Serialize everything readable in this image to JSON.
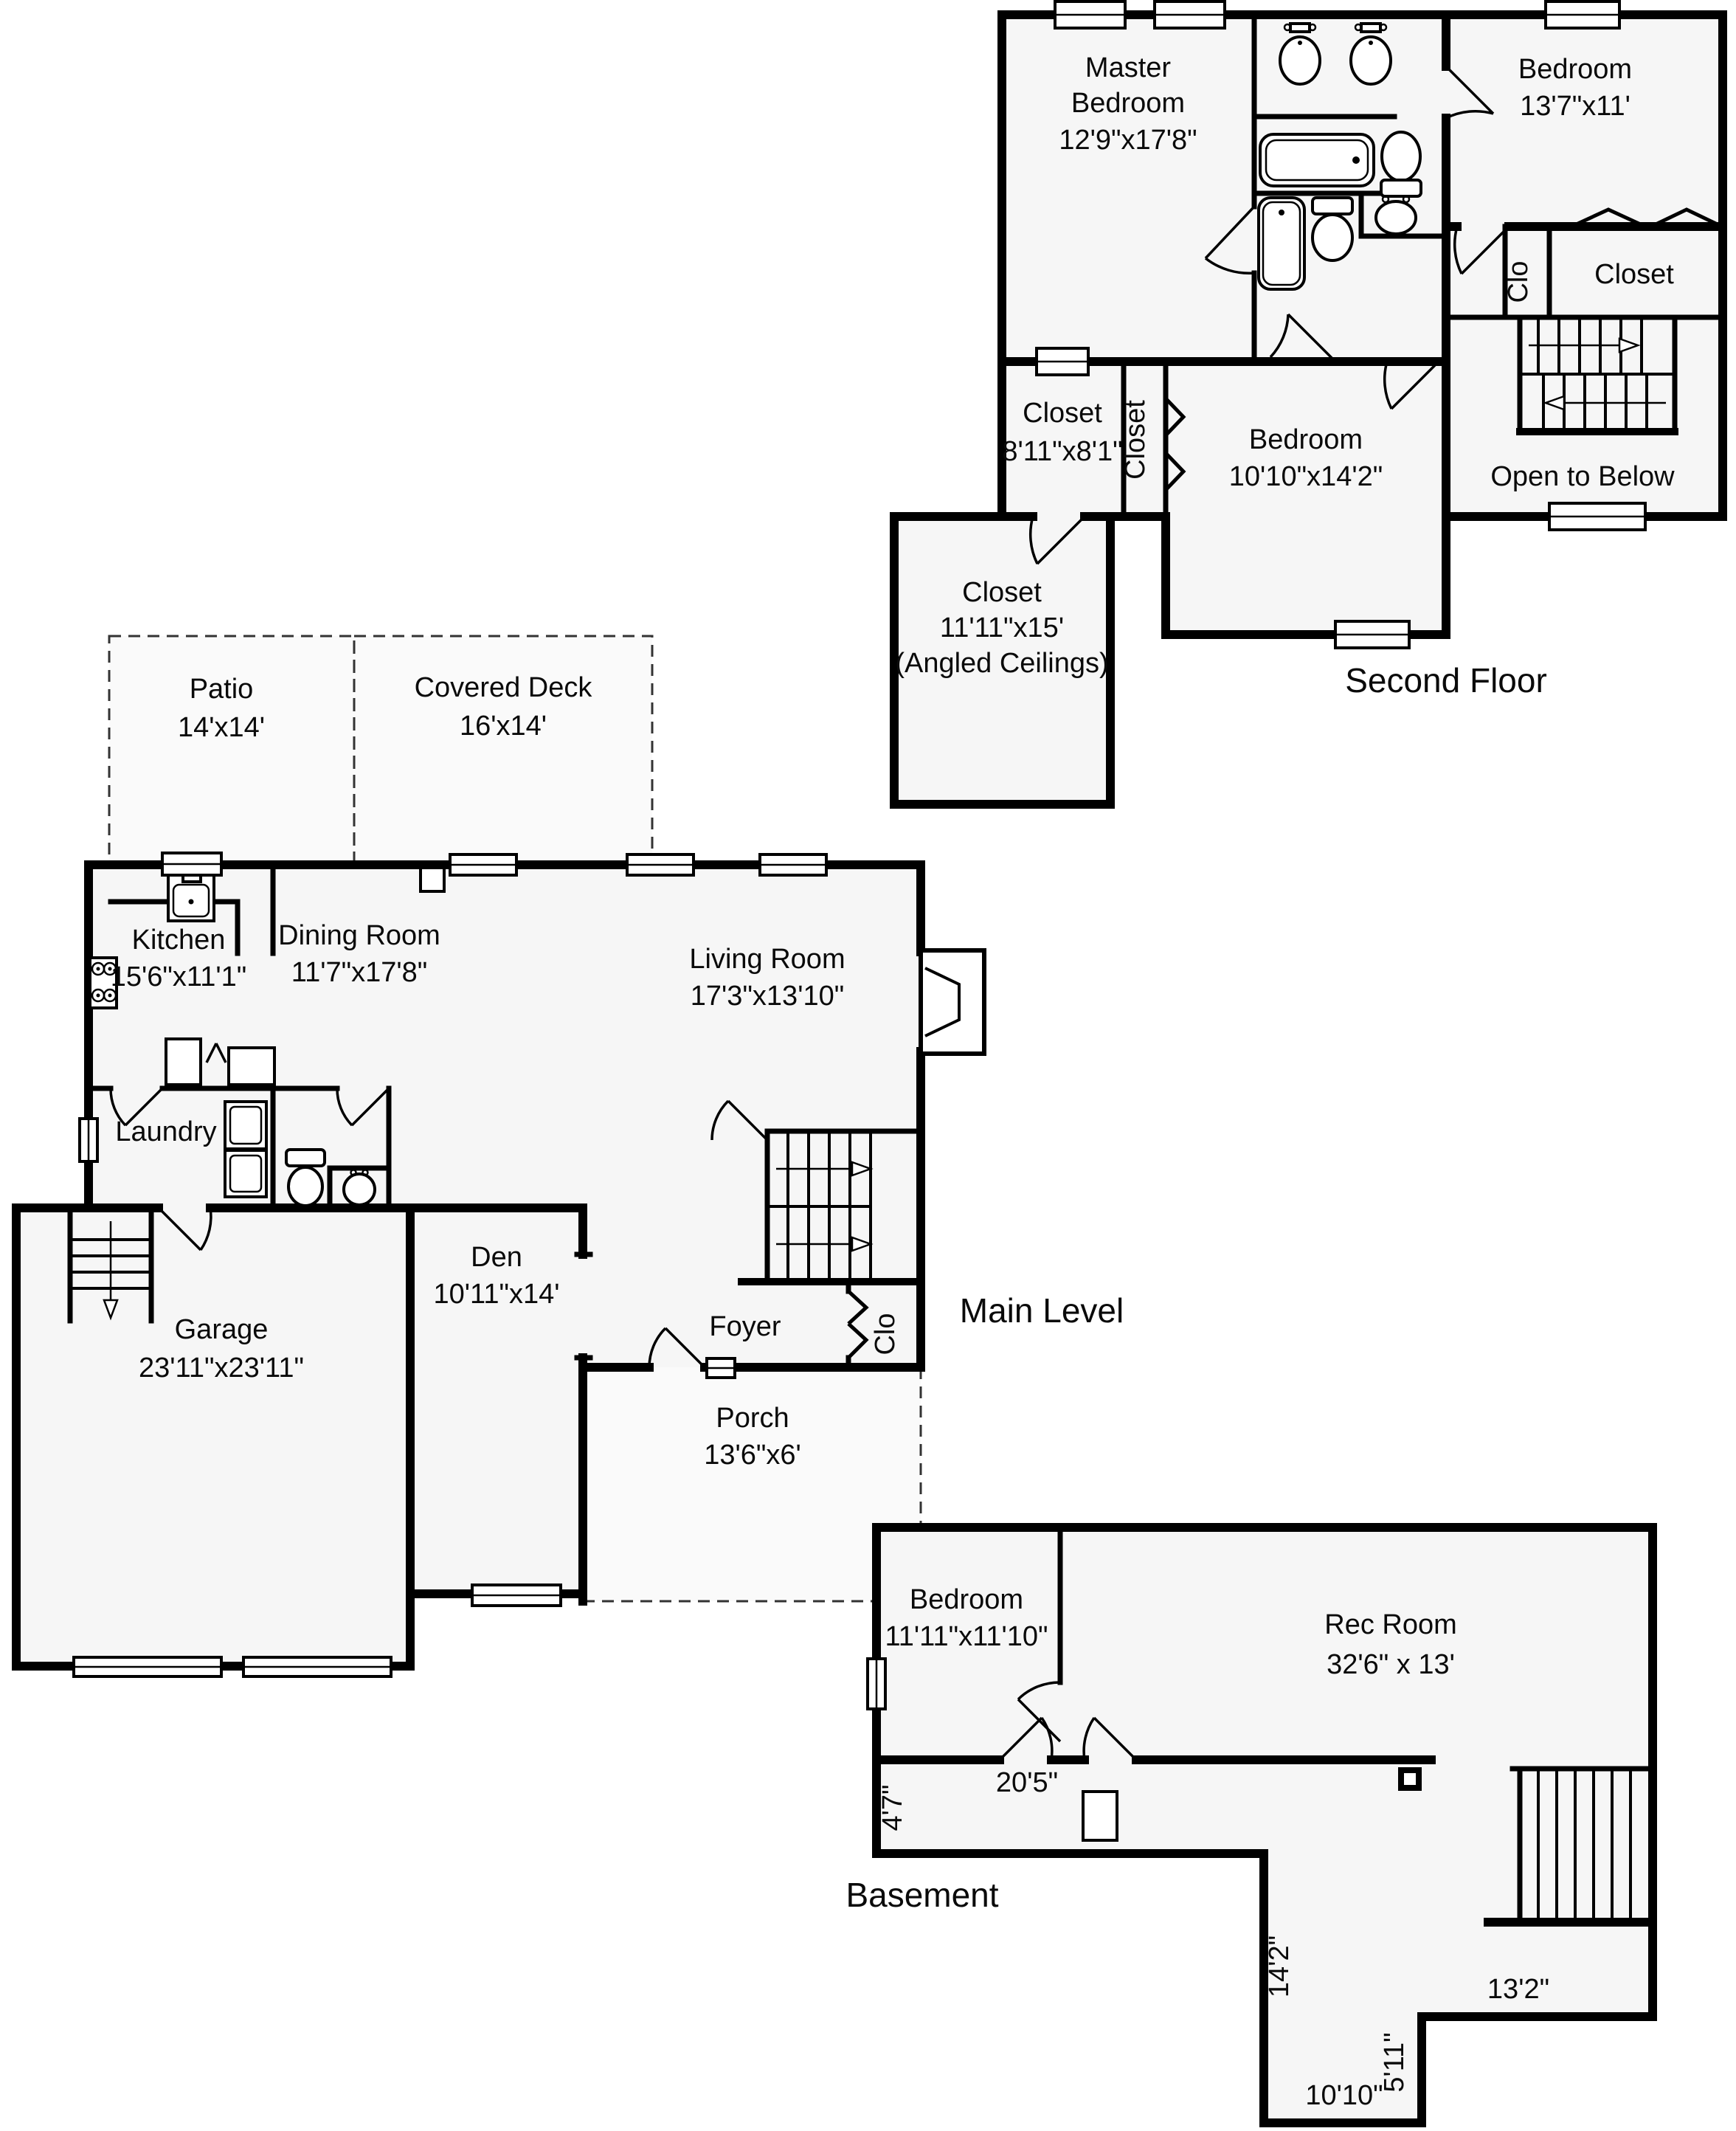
{
  "page": {
    "background": "#ffffff",
    "wall_color": "#000000",
    "floor_fill": "#f6f6f6"
  },
  "second_floor": {
    "title": "Second Floor",
    "master_bedroom": {
      "name_line1": "Master",
      "name_line2": "Bedroom",
      "dims": "12'9\"x17'8\""
    },
    "bedroom_right": {
      "name": "Bedroom",
      "dims": "13'7\"x11'"
    },
    "clo_label": "Clo",
    "closet_right_label": "Closet",
    "closet_mid": {
      "name": "Closet",
      "dims": "8'11\"x8'1\""
    },
    "closet_strip_label": "Closet",
    "bedroom_middle": {
      "name": "Bedroom",
      "dims": "10'10\"x14'2\""
    },
    "open_to_below_label": "Open to Below",
    "closet_angled": {
      "name": "Closet",
      "dims": "11'11\"x15'",
      "note": "(Angled Ceilings)"
    }
  },
  "main_level": {
    "title": "Main Level",
    "patio": {
      "name": "Patio",
      "dims": "14'x14'"
    },
    "covered_deck": {
      "name": "Covered Deck",
      "dims": "16'x14'"
    },
    "kitchen": {
      "name": "Kitchen",
      "dims": "15'6\"x11'1\""
    },
    "dining_room": {
      "name": "Dining Room",
      "dims": "11'7\"x17'8\""
    },
    "living_room": {
      "name": "Living Room",
      "dims": "17'3\"x13'10\""
    },
    "laundry_label": "Laundry",
    "garage": {
      "name": "Garage",
      "dims": "23'11\"x23'11\""
    },
    "den": {
      "name": "Den",
      "dims": "10'11\"x14'"
    },
    "foyer_label": "Foyer",
    "clo_label": "Clo",
    "porch": {
      "name": "Porch",
      "dims": "13'6\"x6'"
    }
  },
  "basement": {
    "title": "Basement",
    "bedroom": {
      "name": "Bedroom",
      "dims": "11'11\"x11'10\""
    },
    "rec_room": {
      "name": "Rec Room",
      "dims": "32'6\" x 13'"
    },
    "dim_20_5": "20'5\"",
    "dim_4_7": "4'7\"",
    "dim_14_2": "14'2\"",
    "dim_13_2": "13'2\"",
    "dim_5_11": "5'11\"",
    "dim_10_10": "10'10\""
  }
}
